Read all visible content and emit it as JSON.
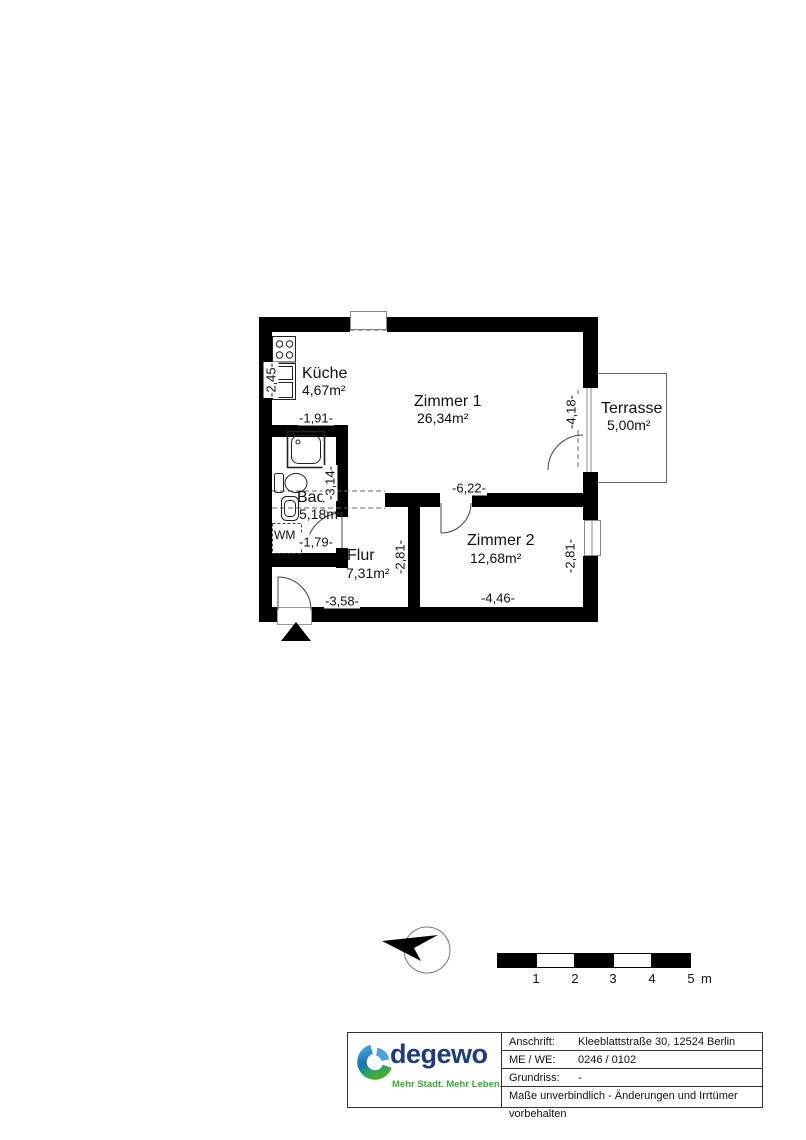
{
  "plan": {
    "rooms": [
      {
        "name": "Küche",
        "area": "4,67m²"
      },
      {
        "name": "Zimmer 1",
        "area": "26,34m²"
      },
      {
        "name": "Terrasse",
        "area": "5,00m²"
      },
      {
        "name": "Bad",
        "area": "5,18m²"
      },
      {
        "name": "Flur",
        "area": "7,31m²"
      },
      {
        "name": "Zimmer 2",
        "area": "12,68m²"
      }
    ],
    "appliances": {
      "washing_machine": "WM"
    },
    "dims": {
      "kueche_depth": "-2,45-",
      "kueche_width": "-1,91-",
      "zimmer1_depth": "-4,18-",
      "zimmer1_width": "-6,22-",
      "bad_depth": "-3,14-",
      "bad_width": "-1,79-",
      "flur_depth": "-2,81-",
      "flur_width": "-3,58-",
      "zimmer2_depth": "-2,81-",
      "zimmer2_width": "-4,46-"
    }
  },
  "scale_bar": {
    "ticks": [
      "1",
      "2",
      "3",
      "4",
      "5"
    ],
    "unit": "m"
  },
  "title_block": {
    "brand": "degewo",
    "tagline": "Mehr Stadt. Mehr Leben.",
    "rows": [
      {
        "label": "Anschrift:",
        "value": "Kleeblattstraße 30, 12524 Berlin"
      },
      {
        "label": "ME / WE:",
        "value": "0246 / 0102"
      },
      {
        "label": "Grundriss:",
        "value": "-"
      }
    ],
    "disclaimer": "Maße unverbindlich - Änderungen und Irrtümer vorbehalten"
  },
  "colors": {
    "wall": "#000000",
    "line": "#555555",
    "brand_blue": "#1d3b7e",
    "brand_light_blue": "#4aa3dc",
    "brand_green": "#3aaa35"
  }
}
